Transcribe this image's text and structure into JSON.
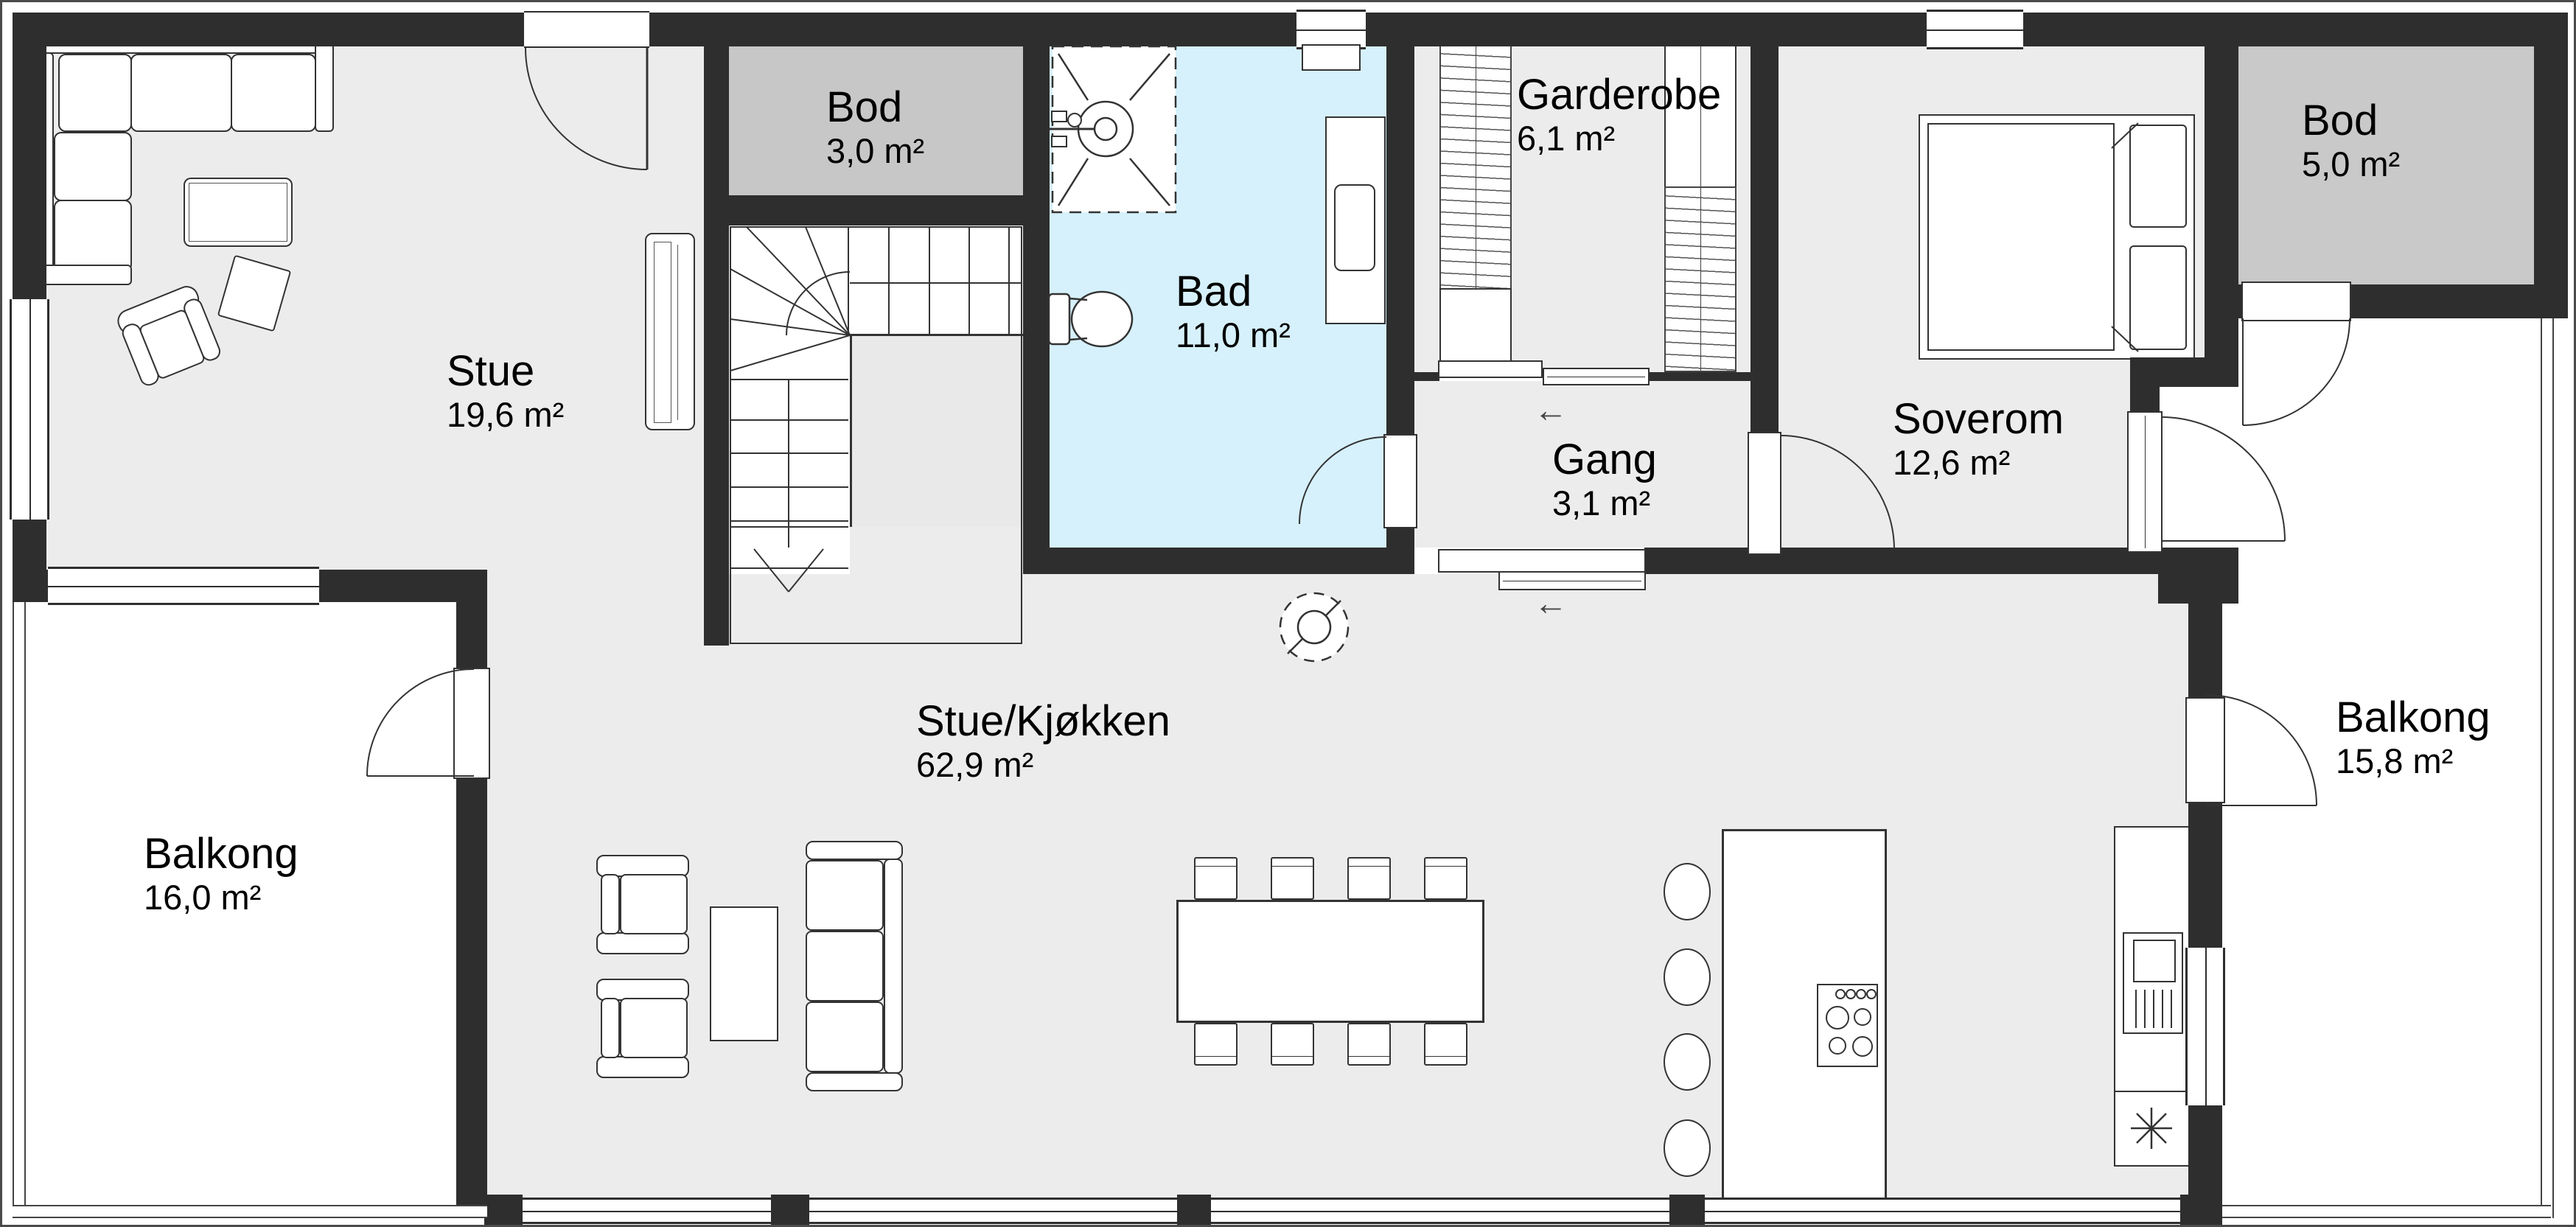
{
  "plan": {
    "rooms": [
      {
        "id": "stue",
        "name": "Stue",
        "area": "19,6 m²"
      },
      {
        "id": "bod-entry",
        "name": "Bod",
        "area": "3,0 m²"
      },
      {
        "id": "bad",
        "name": "Bad",
        "area": "11,0 m²"
      },
      {
        "id": "garderobe",
        "name": "Garderobe",
        "area": "6,1 m²"
      },
      {
        "id": "soverom",
        "name": "Soverom",
        "area": "12,6 m²"
      },
      {
        "id": "gang",
        "name": "Gang",
        "area": "3,1 m²"
      },
      {
        "id": "bod-balcony",
        "name": "Bod",
        "area": "5,0 m²"
      },
      {
        "id": "balkong-left",
        "name": "Balkong",
        "area": "16,0 m²"
      },
      {
        "id": "balkong-right",
        "name": "Balkong",
        "area": "15,8 m²"
      },
      {
        "id": "stue-kjokken",
        "name": "Stue/Kjøkken",
        "area": "62,9 m²"
      }
    ],
    "colors": {
      "wall": "#2e2e2e",
      "floor": "#ececec",
      "storage_floor": "#c8c8c8",
      "bathroom_floor": "#d6f1fc",
      "balcony_floor": "#ffffff",
      "line": "#333333"
    },
    "icons": {
      "slide_arrow": "←"
    }
  }
}
